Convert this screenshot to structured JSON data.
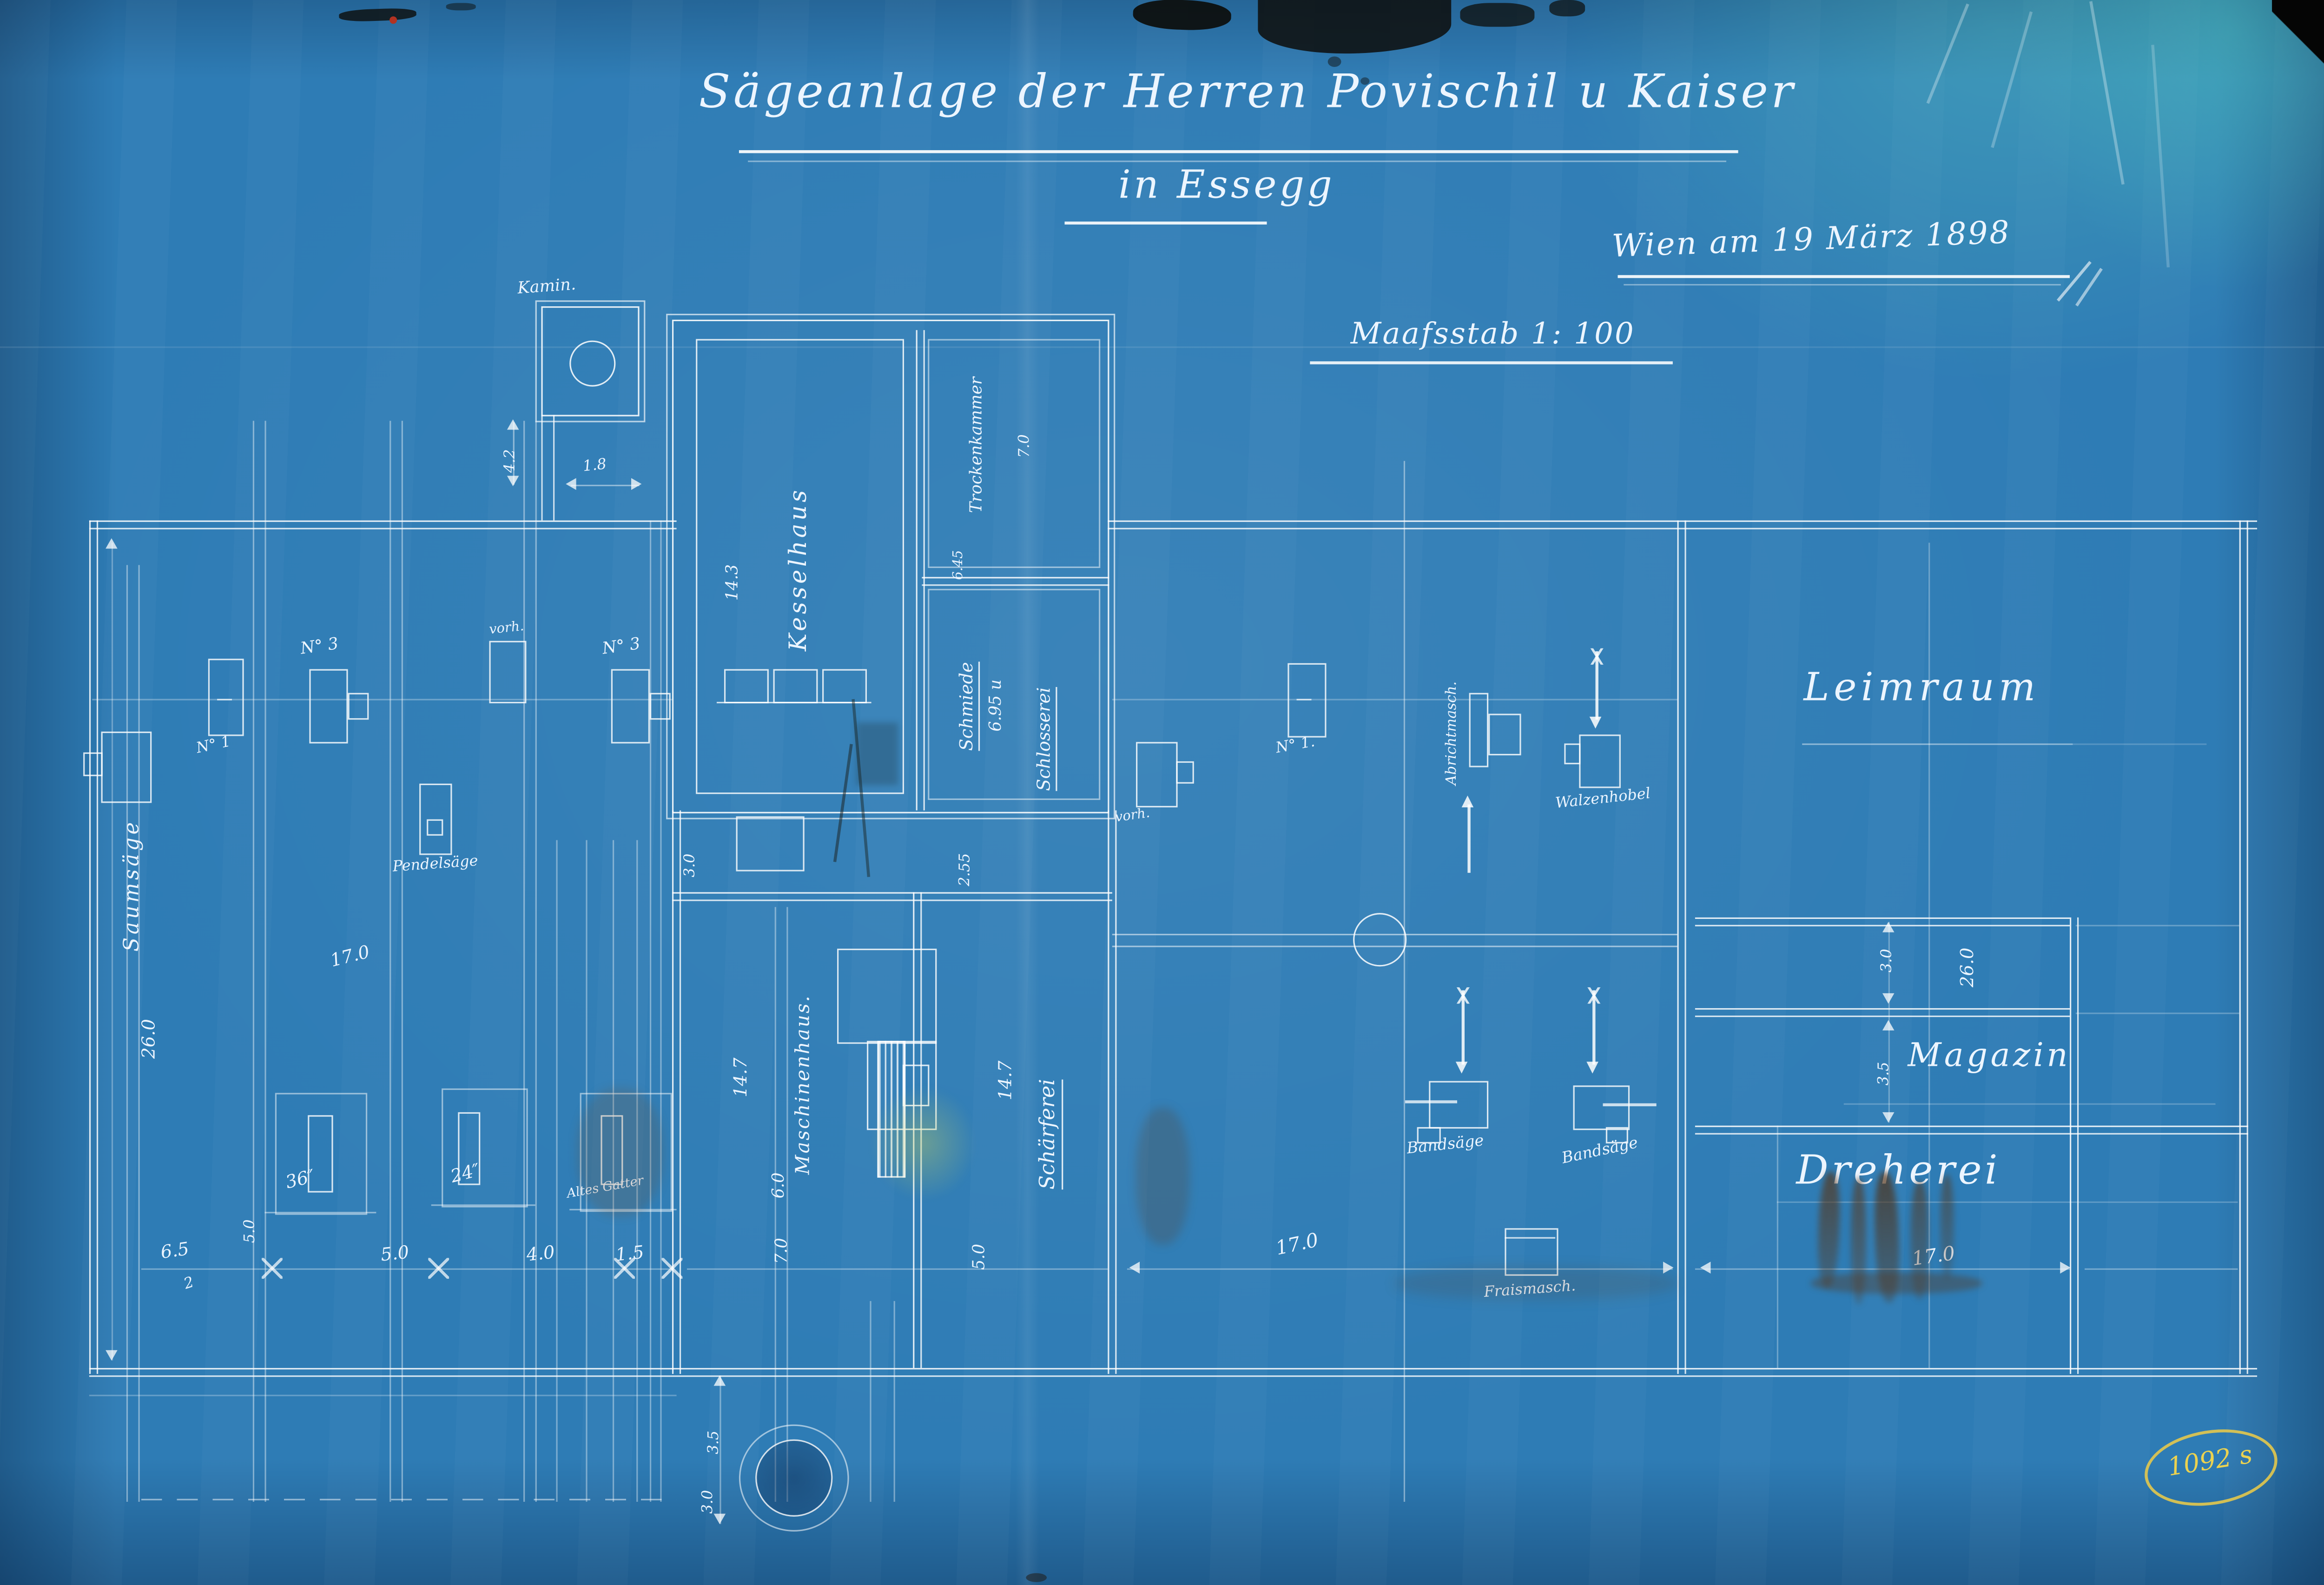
{
  "colors": {
    "paper_blue": "#2e7cb5",
    "line_white": "#ffffff",
    "stamp_yellow": "#e8c83c",
    "rust_brown": "#5a3414"
  },
  "header": {
    "title": "Sägeanlage der Herren Povischil u Kaiser",
    "subtitle": "in Essegg",
    "date_note": "Wien am 19 März 1898",
    "scale_note": "Maafsstab 1: 100"
  },
  "stamp": {
    "number": "1092 s"
  },
  "rooms": {
    "kamin": "Kamin.",
    "kesselhaus": "Kesselhaus",
    "trockenkammer": "Trockenkammer",
    "schmiede": "Schmiede",
    "schlosserei": "Schlosserei",
    "maschinenhaus": "Maschinenhaus.",
    "schaerferei": "Schärferei",
    "leimraum": "Leimraum",
    "magazin": "Magazin",
    "dreherei": "Dreherei"
  },
  "machines": {
    "saumsaege": "Saumsäge",
    "n1": "N° 1",
    "n3a": "N° 3",
    "n3b": "N° 3",
    "pendelsaege": "Pendelsäge",
    "vorha": "vorh.",
    "vorhb": "vorh.",
    "n1b": "N° 1.",
    "abricht": "Abrichtmasch.",
    "walzenhobel": "Walzenhobel",
    "bandsaegea": "Bandsäge",
    "bandsaegeb": "Bandsäge",
    "fraismasch": "Fraismasch.",
    "g36": "36″",
    "g24": "24″",
    "altesgatter": "Altes Gatter"
  },
  "dims": {
    "k42": "4.2",
    "k18": "1.8",
    "k143": "14.3",
    "t70": "7.0",
    "w645": "6.45",
    "s695": "6.95 u",
    "c30": "3.0",
    "c255": "2.55",
    "m147": "14.7",
    "m60": "6.0",
    "m70": "7.0",
    "sf147": "14.7",
    "sf50": "5.0",
    "l260": "26.0",
    "l170": "17.0",
    "b65": "6.5",
    "b50a": "5.0",
    "b2": "2",
    "b50b": "5.0",
    "b40": "4.0",
    "b15": "1.5",
    "mid170": "17.0",
    "r30": "3.0",
    "r260": "26.0",
    "r35": "3.5",
    "r170": "17.0",
    "wl35": "3.5",
    "wl30": "3.0"
  }
}
